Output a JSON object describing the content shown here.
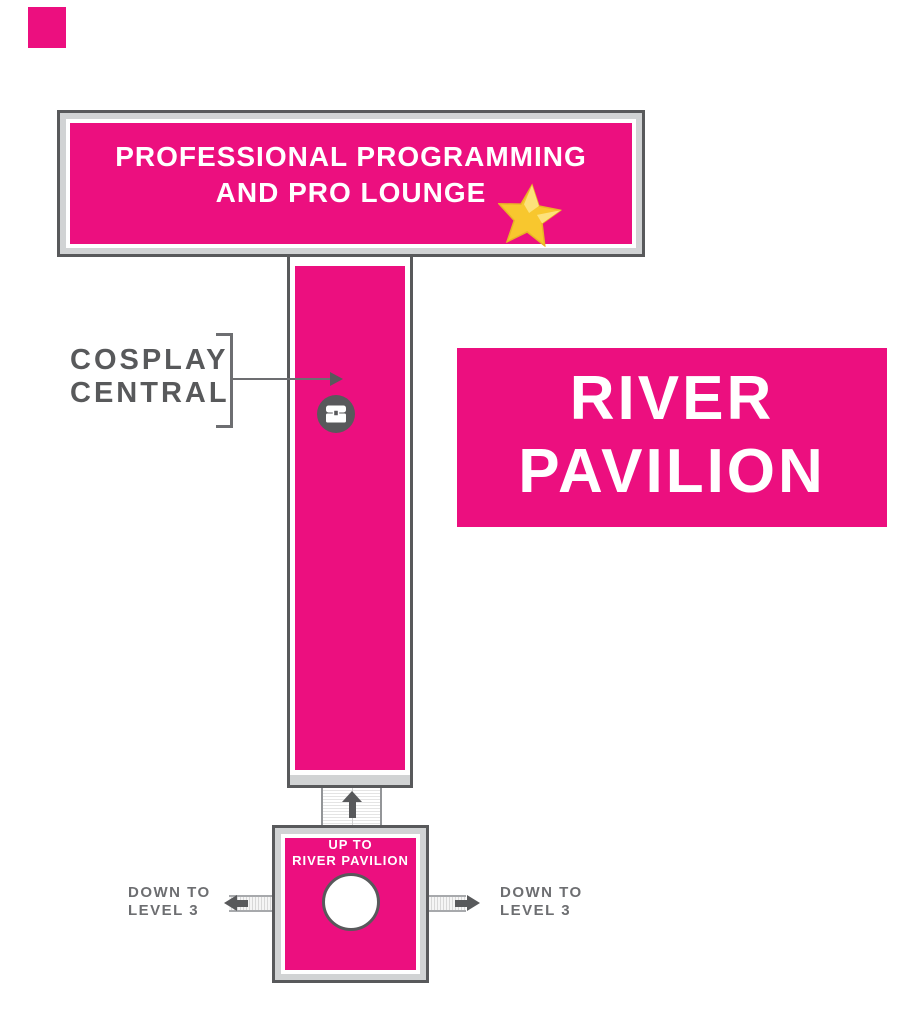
{
  "map_title": "River Pavilion floor map",
  "colors": {
    "pink": "#ec0f7f",
    "frame_fill_gray": "#d1d3d4",
    "border_gray": "#58595b",
    "label_gray": "#6d6e71",
    "star_gold": "#f8c72e",
    "star_highlight": "#fde27a",
    "text_white": "#ffffff"
  },
  "banner": {
    "line1": "PROFESSIONAL PROGRAMMING",
    "line2": "AND PRO LOUNGE"
  },
  "cosplay": {
    "line1": "COSPLAY",
    "line2": "CENTRAL"
  },
  "pavilion": {
    "line1": "RIVER",
    "line2": "PAVILION"
  },
  "room": {
    "line1": "UP TO",
    "line2": "RIVER PAVILION"
  },
  "down_left": {
    "line1": "DOWN TO",
    "line2": "LEVEL 3"
  },
  "down_right": {
    "line1": "DOWN TO",
    "line2": "LEVEL 3"
  },
  "icons": {
    "star": "star-icon",
    "chest": "chest-icon",
    "up_arrow": "up-arrow-icon",
    "left_arrow": "left-arrow-icon",
    "right_arrow": "right-arrow-icon",
    "pointer": "pointer-arrow-icon"
  }
}
